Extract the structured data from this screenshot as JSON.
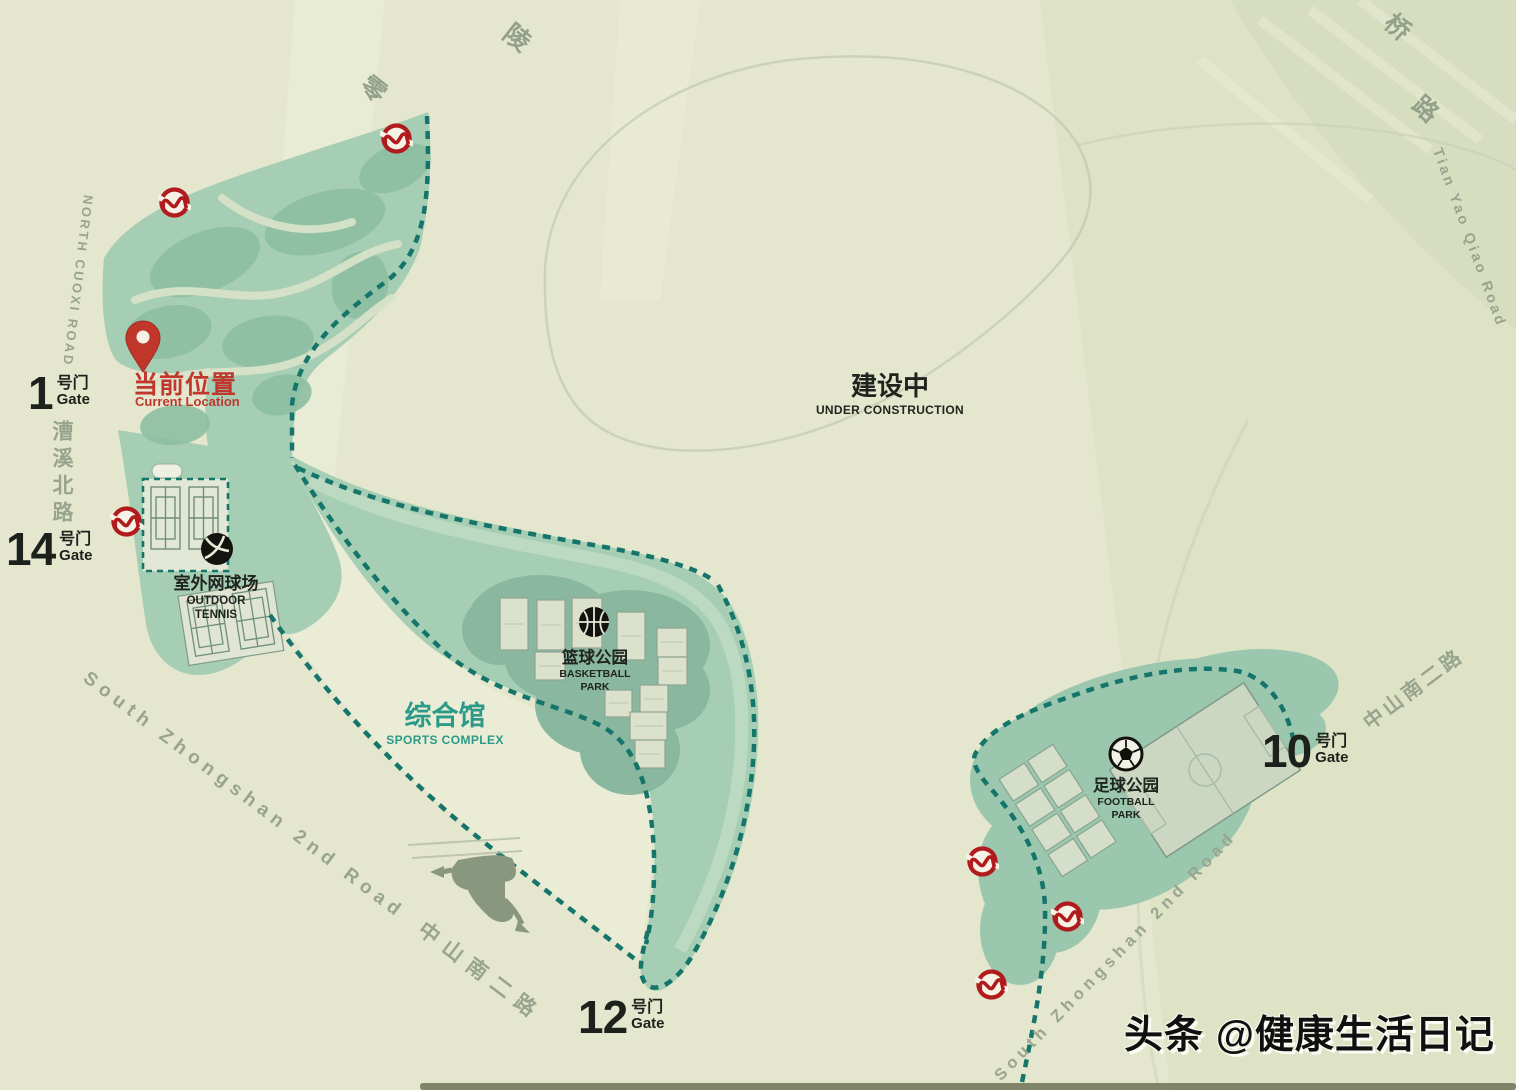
{
  "map": {
    "current_location": {
      "zh": "当前位置",
      "en": "Current Location"
    },
    "under_construction": {
      "zh": "建设中",
      "en": "UNDER CONSTRUCTION"
    },
    "sports_complex": {
      "zh": "综合馆",
      "en": "SPORTS COMPLEX"
    },
    "outdoor_tennis": {
      "zh": "室外网球场",
      "en_line1": "OUTDOOR",
      "en_line2": "TENNIS"
    },
    "basketball_park": {
      "zh": "篮球公园",
      "en_line1": "BASKETBALL",
      "en_line2": "PARK"
    },
    "football_park": {
      "zh": "足球公园",
      "en_line1": "FOOTBALL",
      "en_line2": "PARK"
    },
    "gates": [
      {
        "id": "gate-1",
        "number": "1",
        "label_zh": "号门",
        "label_en": "Gate"
      },
      {
        "id": "gate-14",
        "number": "14",
        "label_zh": "号门",
        "label_en": "Gate"
      },
      {
        "id": "gate-12",
        "number": "12",
        "label_zh": "号门",
        "label_en": "Gate"
      },
      {
        "id": "gate-10",
        "number": "10",
        "label_zh": "号门",
        "label_en": "Gate"
      }
    ],
    "roads": {
      "north_cuoxi": "NORTH CUOXI ROAD",
      "caoxi_north": "漕溪北路",
      "lingling_char1": "零",
      "lingling_char2": "陵",
      "qiao_char": "桥",
      "lu_char": "路",
      "tian_yao_qiao": "Tian Yao Qiao Road",
      "zhongshan_southwest_en": "South Zhongshan 2nd Road",
      "zhongshan_southwest_zh": "中山南二路",
      "zhongshan_southeast": "South Zhongshan 2nd Road",
      "zhongshan_east": "中山南二路"
    },
    "watermark": "头条 @健康生活日记",
    "colors": {
      "background": "#e4e7cd",
      "park_green": "#a6ceb5",
      "park_green_dark": "#8dbfa2",
      "island_green": "#8ab7a0",
      "boundary_dash_teal": "#15756a",
      "label_teal": "#2b9a89",
      "metro_red": "#b21b1e",
      "location_red": "#c0372e",
      "road_text_gray": "#98a48e",
      "ink": "#1d211c"
    }
  }
}
